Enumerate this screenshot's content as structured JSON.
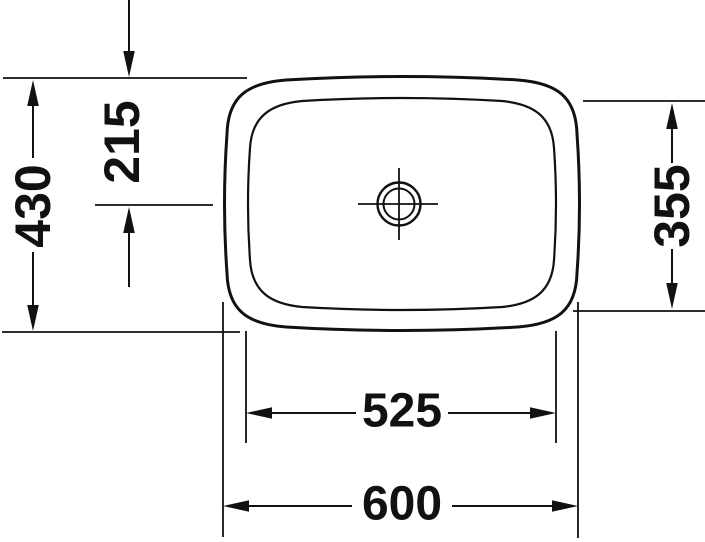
{
  "drawing": {
    "background": "#ffffff",
    "stroke_color": "#111111",
    "labels": {
      "overall_height": "430",
      "drain_center_offset": "215",
      "inner_basin_height": "355",
      "inner_basin_width": "525",
      "overall_width": "600"
    }
  }
}
